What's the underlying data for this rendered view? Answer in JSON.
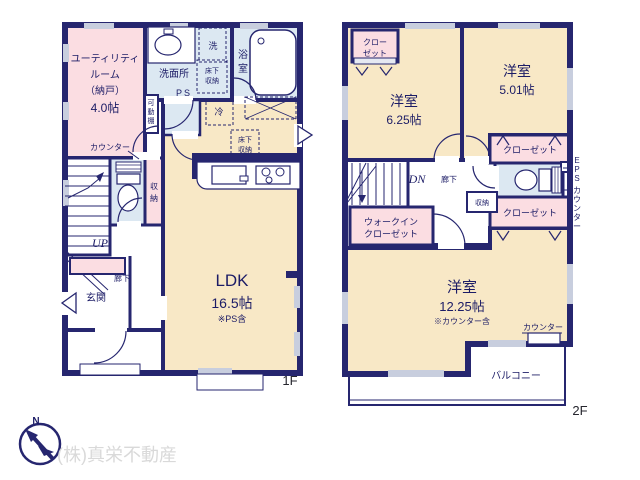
{
  "page": {
    "floor1_label": "1F",
    "floor2_label": "2F",
    "company": "(株)真栄不動産",
    "compass_n": "N"
  },
  "colors": {
    "wall": "#26266f",
    "room_cream": "#f8e8c6",
    "room_pink": "#fbdde2",
    "room_blue": "#dce8f2",
    "window_gray": "#c8cede",
    "label_text": "#1c1c66",
    "company_gray": "#d9d9d9"
  },
  "floor1": {
    "utility": {
      "lines": [
        "ユーティリティ",
        "ルーム",
        "（納戸）",
        "4.0帖"
      ]
    },
    "washroom": {
      "label": "洗面所"
    },
    "laundry": {
      "label": "洗"
    },
    "bath": {
      "chars": [
        "浴",
        "室"
      ]
    },
    "underfloor_a": {
      "lines": [
        "床下",
        "収納"
      ]
    },
    "ps": {
      "label": "PS"
    },
    "movable_shelf": {
      "chars": [
        "可",
        "動",
        "棚"
      ]
    },
    "fridge": {
      "label": "冷"
    },
    "underfloor_b": {
      "lines": [
        "床下",
        "収納"
      ]
    },
    "counter": {
      "label": "カウンター"
    },
    "storage": {
      "chars": [
        "収",
        "納"
      ]
    },
    "stairs": {
      "label": "UP"
    },
    "hallway": {
      "label": "廊下"
    },
    "entrance": {
      "label": "玄関"
    },
    "ldk": {
      "name": "LDK",
      "size": "16.5帖",
      "note": "※PS含"
    }
  },
  "floor2": {
    "closet_nw": {
      "lines": [
        "クロー",
        "ゼット"
      ]
    },
    "room_625": {
      "name": "洋室",
      "size": "6.25帖"
    },
    "room_501": {
      "name": "洋室",
      "size": "5.01帖"
    },
    "closet_e1": {
      "label": "クローゼット"
    },
    "closet_e2": {
      "label": "クローゼット"
    },
    "eps": {
      "chars": [
        "E",
        "P",
        "S"
      ]
    },
    "side_counter": {
      "chars": [
        "カ",
        "ウ",
        "ン",
        "タ",
        "ー"
      ]
    },
    "stairs": {
      "label": "DN"
    },
    "hallway": {
      "label": "廊下"
    },
    "storage": {
      "label": "収納"
    },
    "wic": {
      "lines": [
        "ウォークイン",
        "クローゼット"
      ]
    },
    "room_1225": {
      "name": "洋室",
      "size": "12.25帖",
      "note": "※カウンター含"
    },
    "counter": {
      "label": "カウンター"
    },
    "balcony": {
      "label": "バルコニー"
    }
  }
}
